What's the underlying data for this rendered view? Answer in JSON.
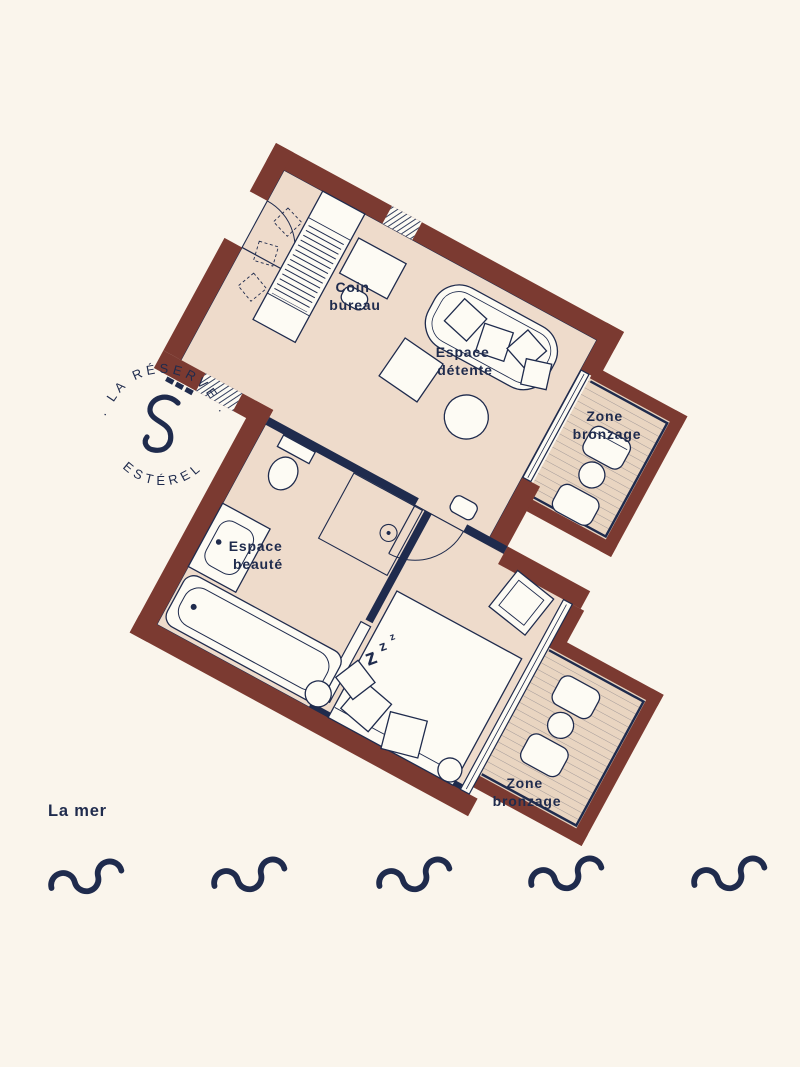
{
  "colors": {
    "background": "#faf5ec",
    "wall": "#7b3a31",
    "floor": "#eedbcb",
    "deck": "#e9d5c1",
    "navy": "#1f2b4d",
    "furniture": "#fdfbf4"
  },
  "logo": {
    "top_text": "· LA RÉSERVE ·",
    "bottom_text": "ESTÉREL",
    "monogram": "S"
  },
  "plan": {
    "rooms": [
      {
        "id": "coin-bureau",
        "line1": "Coin",
        "line2": "bureau"
      },
      {
        "id": "espace-detente",
        "line1": "Espace",
        "line2": "détente"
      },
      {
        "id": "zone-bronzage-1",
        "line1": "Zone",
        "line2": "bronzage"
      },
      {
        "id": "espace-beaute",
        "line1": "Espace",
        "line2": "beauté"
      },
      {
        "id": "zone-bronzage-2",
        "line1": "Zone",
        "line2": "bronzage"
      }
    ],
    "zzz": [
      "z",
      "z",
      "z"
    ]
  },
  "sea": {
    "label": "La mer",
    "wave_count": 5
  }
}
